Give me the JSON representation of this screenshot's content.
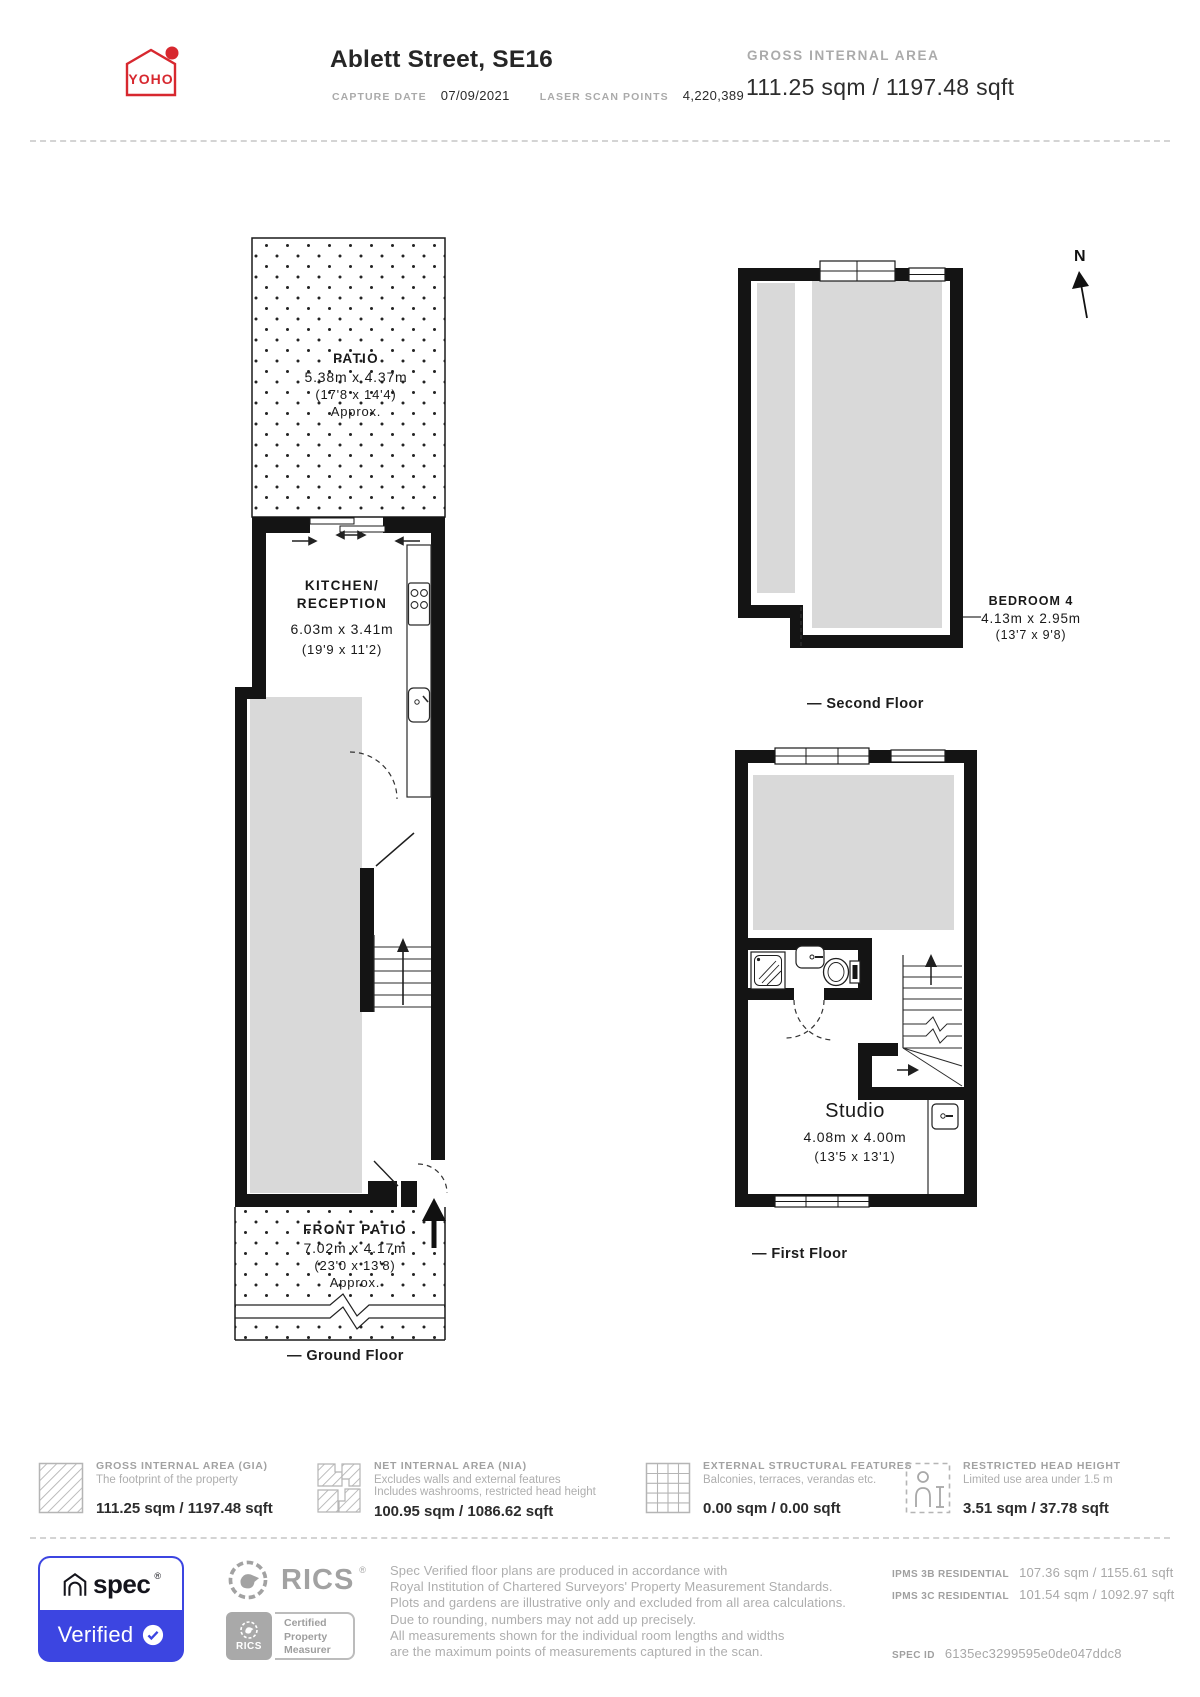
{
  "header": {
    "logo_text": "YOHO",
    "title": "Ablett Street, SE16",
    "capture_date_label": "CAPTURE DATE",
    "capture_date": "07/09/2021",
    "laser_scan_points_label": "LASER SCAN POINTS",
    "laser_scan_points": "4,220,389",
    "gia_label": "GROSS INTERNAL AREA",
    "gia_value": "111.25 sqm / 1197.48 sqft"
  },
  "plans": {
    "north_label": "N",
    "ground_floor": {
      "label": "— Ground Floor",
      "patio": {
        "name": "PATIO",
        "metric": "5.38m x 4.37m",
        "imperial": "(17'8 x 14'4)",
        "approx": "Approx."
      },
      "kitchen": {
        "name_line1": "KITCHEN/",
        "name_line2": "RECEPTION",
        "metric": "6.03m x 3.41m",
        "imperial": "(19'9 x 11'2)"
      },
      "front_patio": {
        "name": "FRONT PATIO",
        "metric": "7.02m x 4.17m",
        "imperial": "(23'0 x 13'8)",
        "approx": "Approx."
      }
    },
    "second_floor": {
      "label": "— Second Floor",
      "bedroom": {
        "name": "BEDROOM 4",
        "metric": "4.13m x 2.95m",
        "imperial": "(13'7 x 9'8)"
      }
    },
    "first_floor": {
      "label": "— First Floor",
      "studio": {
        "name": "Studio",
        "metric": "4.08m x 4.00m",
        "imperial": "(13'5 x 13'1)"
      }
    }
  },
  "legend": [
    {
      "title": "GROSS INTERNAL AREA (GIA)",
      "line1": "The footprint of the property",
      "value": "111.25 sqm / 1197.48 sqft"
    },
    {
      "title": "NET INTERNAL AREA (NIA)",
      "line1": "Excludes walls and external features",
      "line2": "Includes washrooms, restricted head height",
      "value": "100.95 sqm / 1086.62 sqft"
    },
    {
      "title": "EXTERNAL STRUCTURAL FEATURES",
      "line1": "Balconies, terraces, verandas etc.",
      "value": "0.00 sqm / 0.00 sqft"
    },
    {
      "title": "RESTRICTED HEAD HEIGHT",
      "line1": "Limited use area under 1.5 m",
      "value": "3.51 sqm / 37.78 sqft"
    }
  ],
  "footer": {
    "spec_brand": "spec",
    "spec_reg": "®",
    "spec_verified": "Verified",
    "rics_name": "RICS",
    "rics_reg": "®",
    "rics_small": "RICS",
    "cert_line1": "Certified",
    "cert_line2": "Property",
    "cert_line3": "Measurer",
    "disclaimer": [
      "Spec Verified floor plans are produced in accordance with",
      "Royal Institution of Chartered Surveyors' Property Measurement Standards.",
      "Plots and gardens are illustrative only and excluded from all area calculations.",
      "Due to rounding, numbers may not add up precisely.",
      "All measurements shown for the individual room lengths and widths",
      "are the maximum points of measurements captured in the scan."
    ],
    "ipms": [
      {
        "label": "IPMS 3B RESIDENTIAL",
        "value": "107.36 sqm / 1155.61 sqft"
      },
      {
        "label": "IPMS 3C RESIDENTIAL",
        "value": "101.54 sqm / 1092.97 sqft"
      }
    ],
    "spec_id_label": "SPEC ID",
    "spec_id": "6135ec3299595e0de047ddc8"
  },
  "colors": {
    "accent_red": "#d7282f",
    "verified_blue": "#3c45e1",
    "wall_black": "#141414",
    "room_gray": "#d9d9d9",
    "muted_text": "#a8a8a8",
    "dark_text": "#262626"
  }
}
